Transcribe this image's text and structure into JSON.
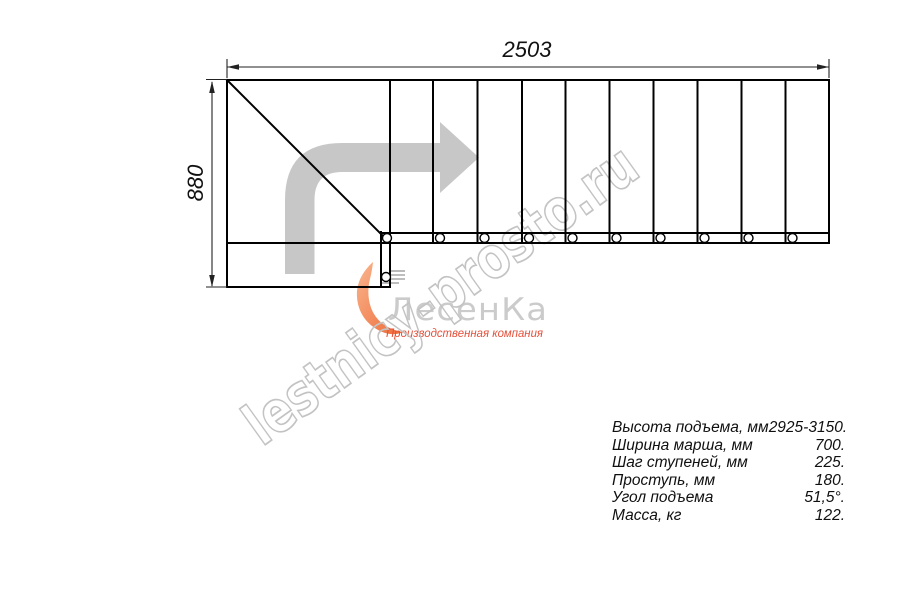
{
  "dimensions": {
    "width_mm": "2503",
    "height_mm": "880"
  },
  "watermark": {
    "text": "lestnicy-prosto.ru",
    "color": "#c3c3c3"
  },
  "logo": {
    "name": "ЛесенКа",
    "tagline": "Производственная компания",
    "name_color": "#cbcbcb",
    "tagline_color": "#e45039",
    "flame_color": "#ef6b36"
  },
  "drawing": {
    "line_color": "#000000",
    "arrow_color": "#c7c7c7",
    "treads_count": 10
  },
  "specs": {
    "rows": [
      {
        "label": "Высота подъема, мм",
        "value": "2925-3150."
      },
      {
        "label": "Ширина марша, мм",
        "value": "700."
      },
      {
        "label": "Шаг ступеней, мм",
        "value": "225."
      },
      {
        "label": "Проступь, мм",
        "value": "180."
      },
      {
        "label": "Угол подъема",
        "value": "51,5°."
      },
      {
        "label": "Масса, кг",
        "value": "122."
      }
    ]
  }
}
